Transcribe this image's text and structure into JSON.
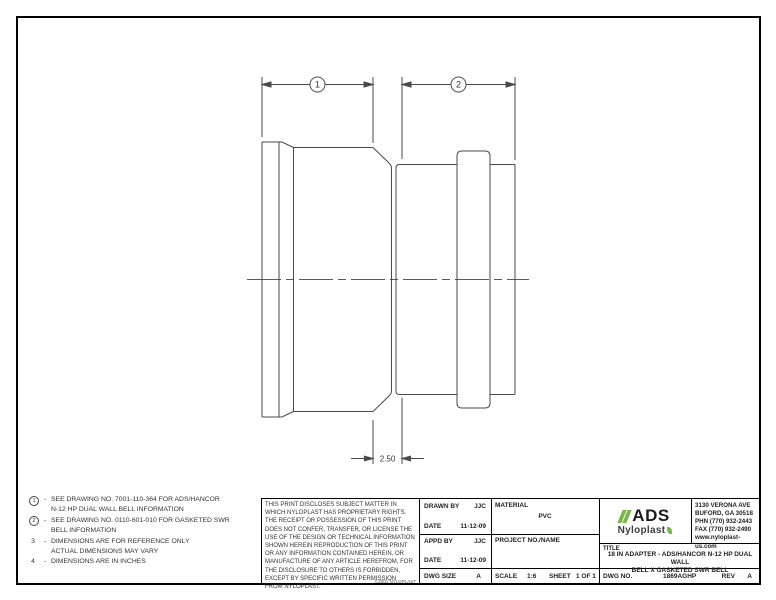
{
  "drawing": {
    "callout_1": "1",
    "callout_2": "2",
    "taper_dim": "2.50"
  },
  "notes": [
    {
      "num": "1",
      "dash": "-",
      "line1": "SEE DRAWING NO. 7001-110-364 FOR ADS/HANCOR",
      "line2": "N-12 HP DUAL WALL BELL INFORMATION"
    },
    {
      "num": "2",
      "dash": "-",
      "line1": "SEE DRAWING NO. 0110-601-010 FOR GASKETED SWR",
      "line2": "BELL INFORMATION"
    },
    {
      "num": "3",
      "dash": "-",
      "line1": "DIMENSIONS ARE FOR REFERENCE ONLY",
      "line2": "ACTUAL DIMENSIONS MAY VARY"
    },
    {
      "num": "4",
      "dash": "-",
      "line1": "DIMENSIONS ARE IN INCHES",
      "line2": ""
    }
  ],
  "title_block": {
    "proprietary": "THIS PRINT DISCLOSES SUBJECT MATTER IN WHICH NYLOPLAST HAS PROPRIETARY RIGHTS.  THE RECEIPT OR POSSESSION OF THIS PRINT DOES NOT CONFER, TRANSFER, OR LICENSE THE USE OF THE DESIGN OR TECHNICAL INFORMATION SHOWN HEREIN REPRODUCTION OF THIS PRINT OR ANY INFORMATION CONTAINED HEREIN, OR MANUFACTURE OF ANY ARTICLE HEREFROM, FOR THE DISCLOSURE TO OTHERS IS FORBIDDEN, EXCEPT BY SPECIFIC WRITTEN PERMISSION FROM NYLOPLAST.",
    "copyright": "©2001 NYLOPLAST",
    "drawn_by_label": "DRAWN BY",
    "drawn_by": "JJC",
    "drawn_date_label": "DATE",
    "drawn_date": "11-12-09",
    "appd_by_label": "APPD BY",
    "appd_by": "JJC",
    "appd_date_label": "DATE",
    "appd_date": "11-12-09",
    "dwg_size_label": "DWG SIZE",
    "dwg_size": "A",
    "material_label": "MATERIAL",
    "material": "PVC",
    "project_label": "PROJECT NO./NAME",
    "scale_label": "SCALE",
    "scale": "1:6",
    "sheet_label": "SHEET",
    "sheet": "1 OF 1",
    "logo": {
      "ads": "ADS",
      "nyloplast": "Nyloplast",
      "accent_color": "#7ab648"
    },
    "address_line1": "3130 VERONA AVE",
    "address_line2": "BUFORD, GA 30518",
    "address_line3": "PHN (770) 932-2443",
    "address_line4": "FAX (770) 932-2490",
    "address_line5": "www.nyloplast-us.com",
    "title_label": "TITLE",
    "title_line1": "18 IN ADAPTER - ADS/HANCOR N-12 HP DUAL WALL",
    "title_line2": "BELL X GASKETED SWR BELL",
    "dwg_no_label": "DWG NO.",
    "dwg_no": "1869AGHP",
    "rev_label": "REV",
    "rev": "A"
  }
}
